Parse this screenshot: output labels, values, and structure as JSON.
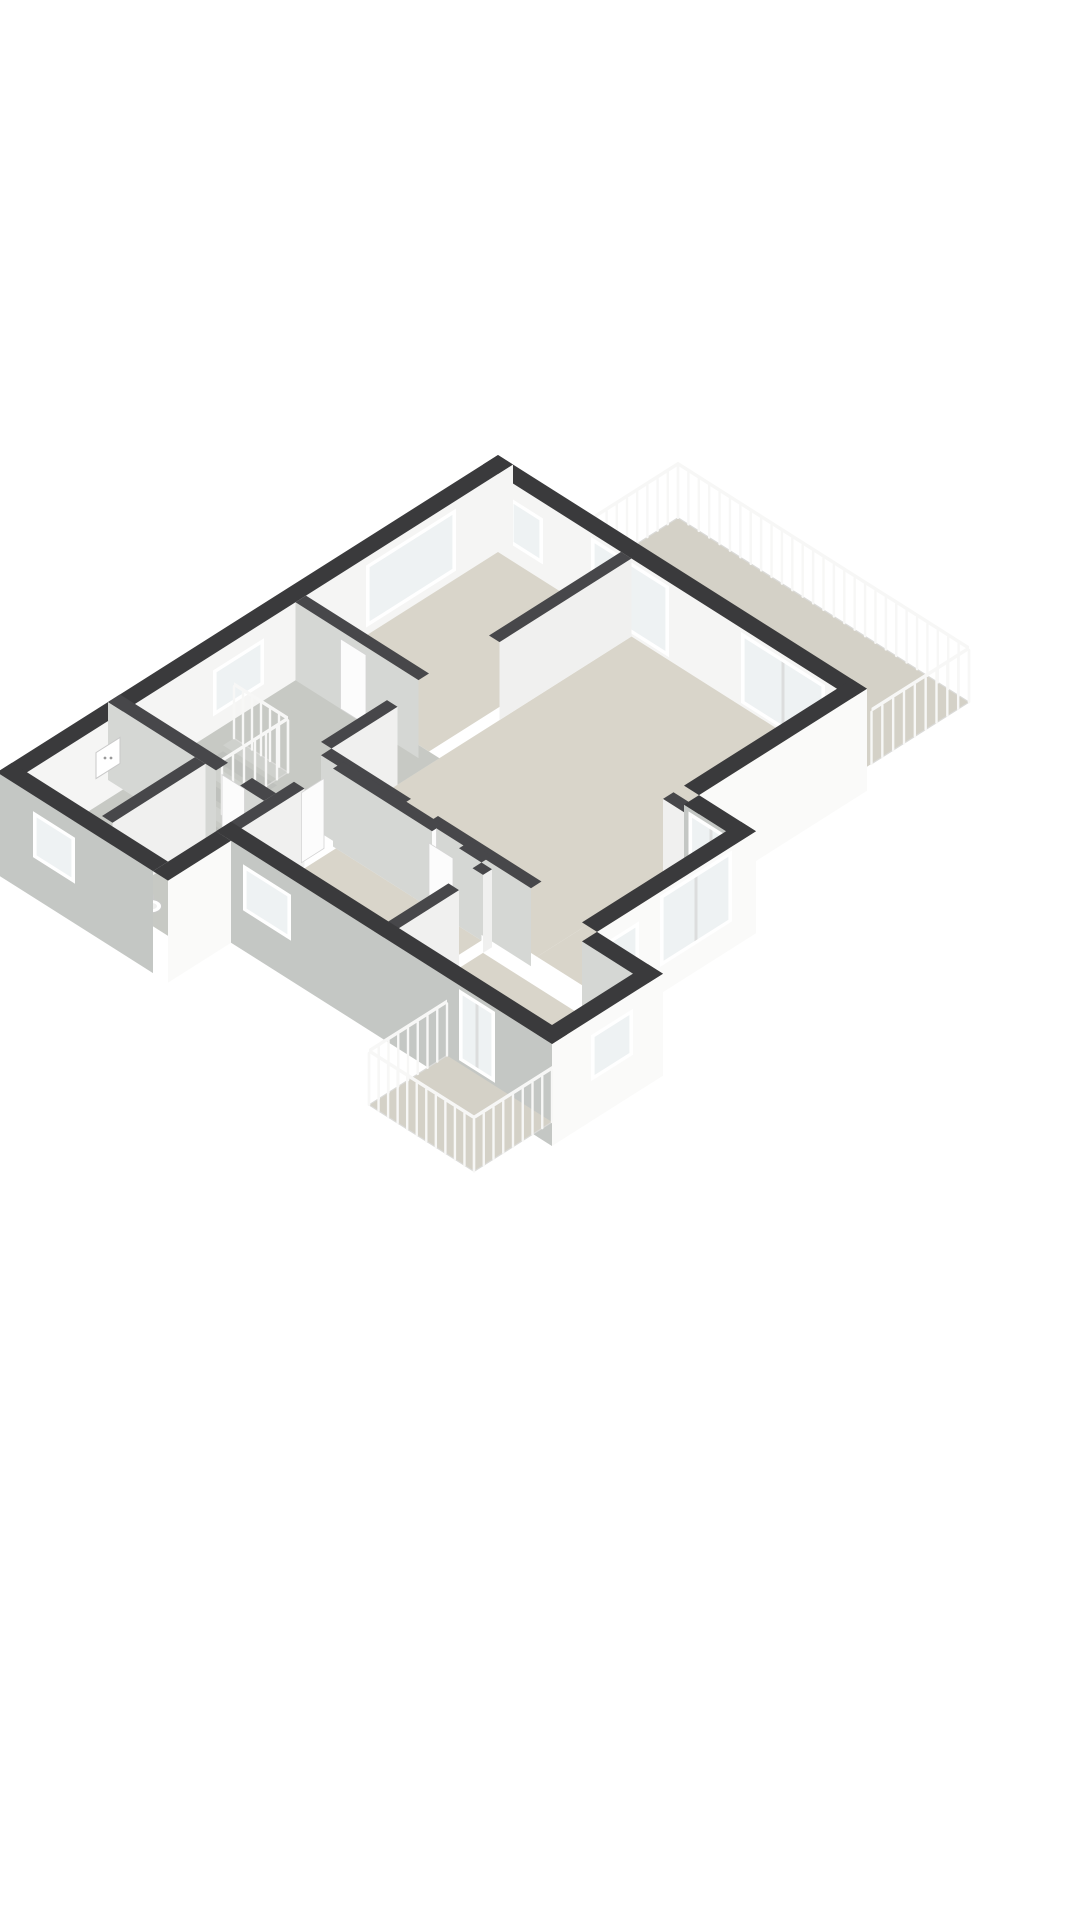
{
  "page": {
    "background": "#ffffff",
    "content_kind": "3d-isometric-floor-plan"
  },
  "colors": {
    "cap": "#3a3a3c",
    "capInt": "#47474a",
    "white": "#f5f5f4",
    "lightFace": "#f0f0ef",
    "grayFace": "#d5d7d4",
    "outGray": "#c4c7c4",
    "outWhite": "#fafaf9",
    "endcap": "#e2e2e1",
    "beige": "#d9d5ca",
    "terr": "#d4d1c7",
    "gray": "#c7c9c4",
    "stairA": "#cfd1cd",
    "stairB": "#bfc1bd",
    "glass": "#eef2f3",
    "frame": "#ffffff",
    "mullion": "#dcdddd",
    "rail": "#f7f7f6",
    "railBase": "#dadad8",
    "door": "#fcfcfc",
    "doorEdge": "#d5d5d5",
    "fixture": "#ffffff",
    "fixtureEdge": "#c9c9c9"
  },
  "scene": {
    "ox": 498,
    "oy": 455,
    "k": 30,
    "kv": 19,
    "wallH": 78,
    "slab": 24,
    "railH": 56,
    "items": [
      {
        "kind": "floor",
        "name": "terrace-floor",
        "rect": [
          2.6,
          -3.4,
          12.3,
          0
        ],
        "fill": "terr"
      },
      {
        "kind": "rail",
        "name": "terrace-railing-nw",
        "axis": "v",
        "at": 2.6,
        "from": -3.4,
        "to": 0,
        "n": 10
      },
      {
        "kind": "rail",
        "name": "terrace-railing-ne",
        "axis": "u",
        "at": -3.4,
        "from": 2.6,
        "to": 12.3,
        "n": 28
      },
      {
        "kind": "rail",
        "name": "terrace-railing-se",
        "axis": "v",
        "at": 12.3,
        "from": -3.4,
        "to": -0.15,
        "n": 9
      },
      {
        "kind": "wall",
        "name": "exterior-wall-ne",
        "axis": "u",
        "at": 0,
        "inward": 1,
        "t": 0.5,
        "from": 0,
        "to": 12.3,
        "ext": true,
        "cap": "cap",
        "face": "white"
      },
      {
        "kind": "window",
        "name": "window-ne-small",
        "axis": "u",
        "at": 0.5,
        "from": 0.9,
        "to": 2.0,
        "z1": 16,
        "z2": 62
      },
      {
        "kind": "window",
        "name": "slider-ne-1",
        "axis": "u",
        "at": 0.5,
        "from": 3.6,
        "to": 6.2,
        "z1": 3,
        "z2": 74,
        "slider": true
      },
      {
        "kind": "window",
        "name": "slider-ne-2",
        "axis": "u",
        "at": 0.5,
        "from": 8.6,
        "to": 11.4,
        "z1": 3,
        "z2": 74,
        "slider": true
      },
      {
        "kind": "wall",
        "name": "exterior-wall-nw",
        "axis": "v",
        "at": 0,
        "inward": 1,
        "t": 0.5,
        "from": 0,
        "to": 16.6,
        "ext": true,
        "cap": "cap",
        "face": "white",
        "endcap": true
      },
      {
        "kind": "window",
        "name": "window-nw-large",
        "axis": "v",
        "at": 0.5,
        "from": 1.9,
        "to": 4.9,
        "z1": 8,
        "z2": 70
      },
      {
        "kind": "window",
        "name": "window-nw-hall",
        "axis": "v",
        "at": 0.5,
        "from": 8.3,
        "to": 10.0,
        "z1": 16,
        "z2": 62
      },
      {
        "kind": "floor",
        "name": "bedroom-1-floor",
        "rect": [
          0.5,
          0.5,
          4.6,
          6.9
        ],
        "fill": "beige"
      },
      {
        "kind": "floor",
        "name": "living-room-floor",
        "rect": [
          4.95,
          0.5,
          11.8,
          10.5
        ],
        "fill": "beige"
      },
      {
        "kind": "floor",
        "name": "living-room-floor-east",
        "rect": [
          11.8,
          6.3,
          13.7,
          10.5
        ],
        "fill": "beige"
      },
      {
        "kind": "floor",
        "name": "hallway-floor",
        "rect": [
          0.5,
          6.9,
          4.95,
          12.6
        ],
        "fill": "gray"
      },
      {
        "kind": "stairs",
        "name": "staircase",
        "rect": [
          1.0,
          9.8,
          2.8,
          12.0
        ],
        "steps": 6
      },
      {
        "kind": "rail",
        "name": "stair-railing-ne",
        "axis": "u",
        "at": 9.8,
        "from": 1.0,
        "to": 2.8,
        "n": 6
      },
      {
        "kind": "rail",
        "name": "stair-railing-se",
        "axis": "v",
        "at": 2.8,
        "from": 9.8,
        "to": 12.0,
        "n": 6
      },
      {
        "kind": "wall",
        "name": "wall-bedroom1-living",
        "axis": "v",
        "at": 4.6,
        "inward": 1,
        "t": 0.35,
        "from": 0.5,
        "to": 4.9,
        "cap": "capInt",
        "face": "lightFace"
      },
      {
        "kind": "wall",
        "name": "wall-bedroom1-hall",
        "axis": "u",
        "at": 6.9,
        "inward": 1,
        "t": 0.35,
        "from": 0.5,
        "to": 4.6,
        "cap": "capInt",
        "face": "grayFace"
      },
      {
        "kind": "door",
        "name": "door-bedroom1",
        "axis": "u",
        "at": 7.25,
        "from": 2.0,
        "to": 2.85
      },
      {
        "kind": "wall",
        "name": "wall-hall-living",
        "axis": "v",
        "at": 4.6,
        "inward": 1,
        "t": 0.35,
        "from": 8.3,
        "to": 10.5,
        "cap": "capInt",
        "face": "lightFace"
      },
      {
        "kind": "wall",
        "name": "wall-living-south-a",
        "axis": "u",
        "at": 10.5,
        "inward": 1,
        "t": 0.35,
        "from": 4.95,
        "to": 7.6,
        "cap": "capInt",
        "face": "grayFace"
      },
      {
        "kind": "wall",
        "name": "wall-living-south-b",
        "axis": "u",
        "at": 10.5,
        "inward": 1,
        "t": 0.35,
        "from": 8.5,
        "to": 11.95,
        "cap": "capInt",
        "face": "grayFace"
      },
      {
        "kind": "door",
        "name": "door-living",
        "axis": "v",
        "at": 8.45,
        "from": 10.5,
        "to": 11.3
      },
      {
        "kind": "wall",
        "name": "wall-bedroom-right",
        "axis": "u",
        "at": 6.3,
        "inward": -1,
        "t": 0.35,
        "from": 11.8,
        "to": 13.7,
        "cap": "capInt",
        "face": "lightFace"
      },
      {
        "kind": "wall",
        "name": "wall-leftwing-north-a",
        "axis": "u",
        "at": 12.6,
        "inward": 1,
        "t": 0.4,
        "from": 0,
        "to": 3.6,
        "cap": "capInt",
        "face": "grayFace"
      },
      {
        "kind": "wall",
        "name": "wall-leftwing-north-b",
        "axis": "u",
        "at": 12.6,
        "inward": 1,
        "t": 0.4,
        "from": 4.4,
        "to": 5.2,
        "cap": "capInt",
        "face": "grayFace"
      },
      {
        "kind": "door",
        "name": "door-wc",
        "axis": "u",
        "at": 12.8,
        "from": 3.6,
        "to": 4.35
      },
      {
        "kind": "floor",
        "name": "bathroom-floor",
        "rect": [
          0.5,
          13.0,
          2.9,
          16.1
        ],
        "fill": "gray"
      },
      {
        "kind": "floor",
        "name": "wc-floor",
        "rect": [
          3.25,
          13.0,
          5.2,
          16.1
        ],
        "fill": "gray"
      },
      {
        "kind": "wall",
        "name": "wall-bath-wc",
        "axis": "v",
        "at": 2.9,
        "inward": 1,
        "t": 0.35,
        "from": 13.0,
        "to": 16.1,
        "cap": "capInt",
        "face": "lightFace"
      },
      {
        "kind": "panel",
        "name": "electrical-panel",
        "u": 0.5,
        "v1": 13.1,
        "v2": 13.9,
        "z1": 28,
        "z2": 54
      },
      {
        "kind": "toilet",
        "name": "toilet",
        "u": 4.15,
        "v": 15.7
      },
      {
        "kind": "floor",
        "name": "bedroom-2-floor",
        "rect": [
          5.6,
          11.0,
          10.45,
          14.1
        ],
        "fill": "beige"
      },
      {
        "kind": "wall",
        "name": "wall-hall-bedroom2",
        "axis": "v",
        "at": 5.2,
        "inward": 1,
        "t": 0.35,
        "from": 12.0,
        "to": 14.6,
        "cap": "capInt",
        "face": "lightFace"
      },
      {
        "kind": "door",
        "name": "door-bedroom2",
        "axis": "v",
        "at": 5.4,
        "from": 11.2,
        "to": 11.95
      },
      {
        "kind": "wall",
        "name": "wall-bedroom2-north-a",
        "axis": "u",
        "at": 11.0,
        "inward": -1,
        "t": 0.35,
        "from": 5.5,
        "to": 8.8,
        "cap": "capInt",
        "face": "grayFace"
      },
      {
        "kind": "wall",
        "name": "wall-bedroom2-north-b",
        "axis": "u",
        "at": 11.0,
        "inward": -1,
        "t": 0.35,
        "from": 9.7,
        "to": 10.45,
        "cap": "capInt",
        "face": "grayFace"
      },
      {
        "kind": "door",
        "name": "door-bedroom2-b",
        "axis": "u",
        "at": 11.15,
        "from": 8.85,
        "to": 9.65
      },
      {
        "kind": "wall",
        "name": "wall-bedroom2-3-upper",
        "axis": "v",
        "at": 10.45,
        "inward": 1,
        "t": 0.35,
        "from": 11.0,
        "to": 11.3,
        "cap": "capInt",
        "face": "lightFace"
      },
      {
        "kind": "wall",
        "name": "wall-bedroom2-3",
        "axis": "v",
        "at": 10.45,
        "inward": 1,
        "t": 0.35,
        "from": 12.1,
        "to": 14.6,
        "cap": "capInt",
        "face": "lightFace"
      },
      {
        "kind": "floor",
        "name": "bedroom-3-floor",
        "rect": [
          10.8,
          11.3,
          15.9,
          14.1
        ],
        "fill": "beige"
      },
      {
        "kind": "wall",
        "name": "exterior-wall-se-a",
        "axis": "v",
        "at": 11.8,
        "inward": 1,
        "t": 0.5,
        "from": 0,
        "to": 5.6,
        "ext": true,
        "cap": "cap",
        "face": "outWhite"
      },
      {
        "kind": "wall",
        "name": "exterior-wall-jog-a",
        "axis": "u",
        "at": 5.6,
        "inward": 1,
        "t": 0.5,
        "from": 12.3,
        "to": 14.2,
        "ext": true,
        "cap": "cap",
        "face": "outGray"
      },
      {
        "kind": "window",
        "name": "slider-bedroom-right",
        "axis": "u",
        "at": 6.1,
        "from": 12.45,
        "to": 13.95,
        "z1": 3,
        "z2": 74,
        "slider": true
      },
      {
        "kind": "wall",
        "name": "exterior-wall-se-b",
        "axis": "v",
        "at": 13.7,
        "inward": 1,
        "t": 0.5,
        "from": 5.6,
        "to": 10.9,
        "ext": true,
        "cap": "cap",
        "face": "outWhite"
      },
      {
        "kind": "window",
        "name": "slider-se",
        "axis": "v",
        "at": 14.2,
        "from": 6.4,
        "to": 8.8,
        "z1": 3,
        "z2": 74,
        "slider": true
      },
      {
        "kind": "window",
        "name": "window-se-small",
        "axis": "v",
        "at": 14.2,
        "from": 9.5,
        "to": 10.6,
        "z1": 16,
        "z2": 62
      },
      {
        "kind": "wall",
        "name": "exterior-wall-jog-b",
        "axis": "u",
        "at": 10.9,
        "inward": 1,
        "t": 0.5,
        "from": 14.2,
        "to": 16.4,
        "ext": true,
        "cap": "cap",
        "face": "grayFace"
      },
      {
        "kind": "wall",
        "name": "exterior-wall-se-c",
        "axis": "v",
        "at": 15.9,
        "inward": 1,
        "t": 0.5,
        "from": 10.9,
        "to": 14.6,
        "ext": true,
        "cap": "cap",
        "face": "outWhite",
        "endcap": true
      },
      {
        "kind": "window",
        "name": "window-bedroom3",
        "axis": "v",
        "at": 16.4,
        "from": 11.9,
        "to": 13.3,
        "z1": 16,
        "z2": 62
      },
      {
        "kind": "wall",
        "name": "exterior-wall-sw-wing",
        "axis": "u",
        "at": 14.1,
        "inward": 1,
        "t": 0.5,
        "from": 5.2,
        "to": 16.4,
        "ext": true,
        "cap": "cap",
        "face": "outGray"
      },
      {
        "kind": "window",
        "name": "window-bedroom2",
        "axis": "u",
        "at": 14.6,
        "from": 6.1,
        "to": 7.7,
        "z1": 16,
        "z2": 62
      },
      {
        "kind": "window",
        "name": "slider-balcony",
        "axis": "u",
        "at": 14.6,
        "from": 13.3,
        "to": 14.5,
        "z1": 3,
        "z2": 74,
        "slider": true
      },
      {
        "kind": "floor",
        "name": "balcony-floor",
        "rect": [
          12.9,
          14.6,
          16.4,
          17.2
        ],
        "fill": "terr"
      },
      {
        "kind": "rail",
        "name": "balcony-railing-nw",
        "axis": "v",
        "at": 12.9,
        "from": 14.6,
        "to": 17.2,
        "n": 8
      },
      {
        "kind": "rail",
        "name": "balcony-railing-sw",
        "axis": "u",
        "at": 17.2,
        "from": 12.9,
        "to": 16.4,
        "n": 11
      },
      {
        "kind": "rail",
        "name": "balcony-railing-se",
        "axis": "v",
        "at": 16.4,
        "from": 14.6,
        "to": 17.2,
        "n": 8
      },
      {
        "kind": "wall",
        "name": "exterior-wall-sw-left",
        "axis": "u",
        "at": 16.2,
        "inward": 1,
        "t": 0.5,
        "from": 0,
        "to": 5.2,
        "ext": true,
        "cap": "cap",
        "face": "outGray"
      },
      {
        "kind": "window",
        "name": "window-bathroom",
        "axis": "u",
        "at": 16.7,
        "from": 1.2,
        "to": 2.6,
        "z1": 16,
        "z2": 62
      },
      {
        "kind": "wall",
        "name": "exterior-wall-jog-d",
        "axis": "v",
        "at": 5.2,
        "inward": 1,
        "t": 0.5,
        "from": 14.6,
        "to": 16.7,
        "ext": true,
        "cap": "cap",
        "face": "outWhite"
      }
    ]
  }
}
